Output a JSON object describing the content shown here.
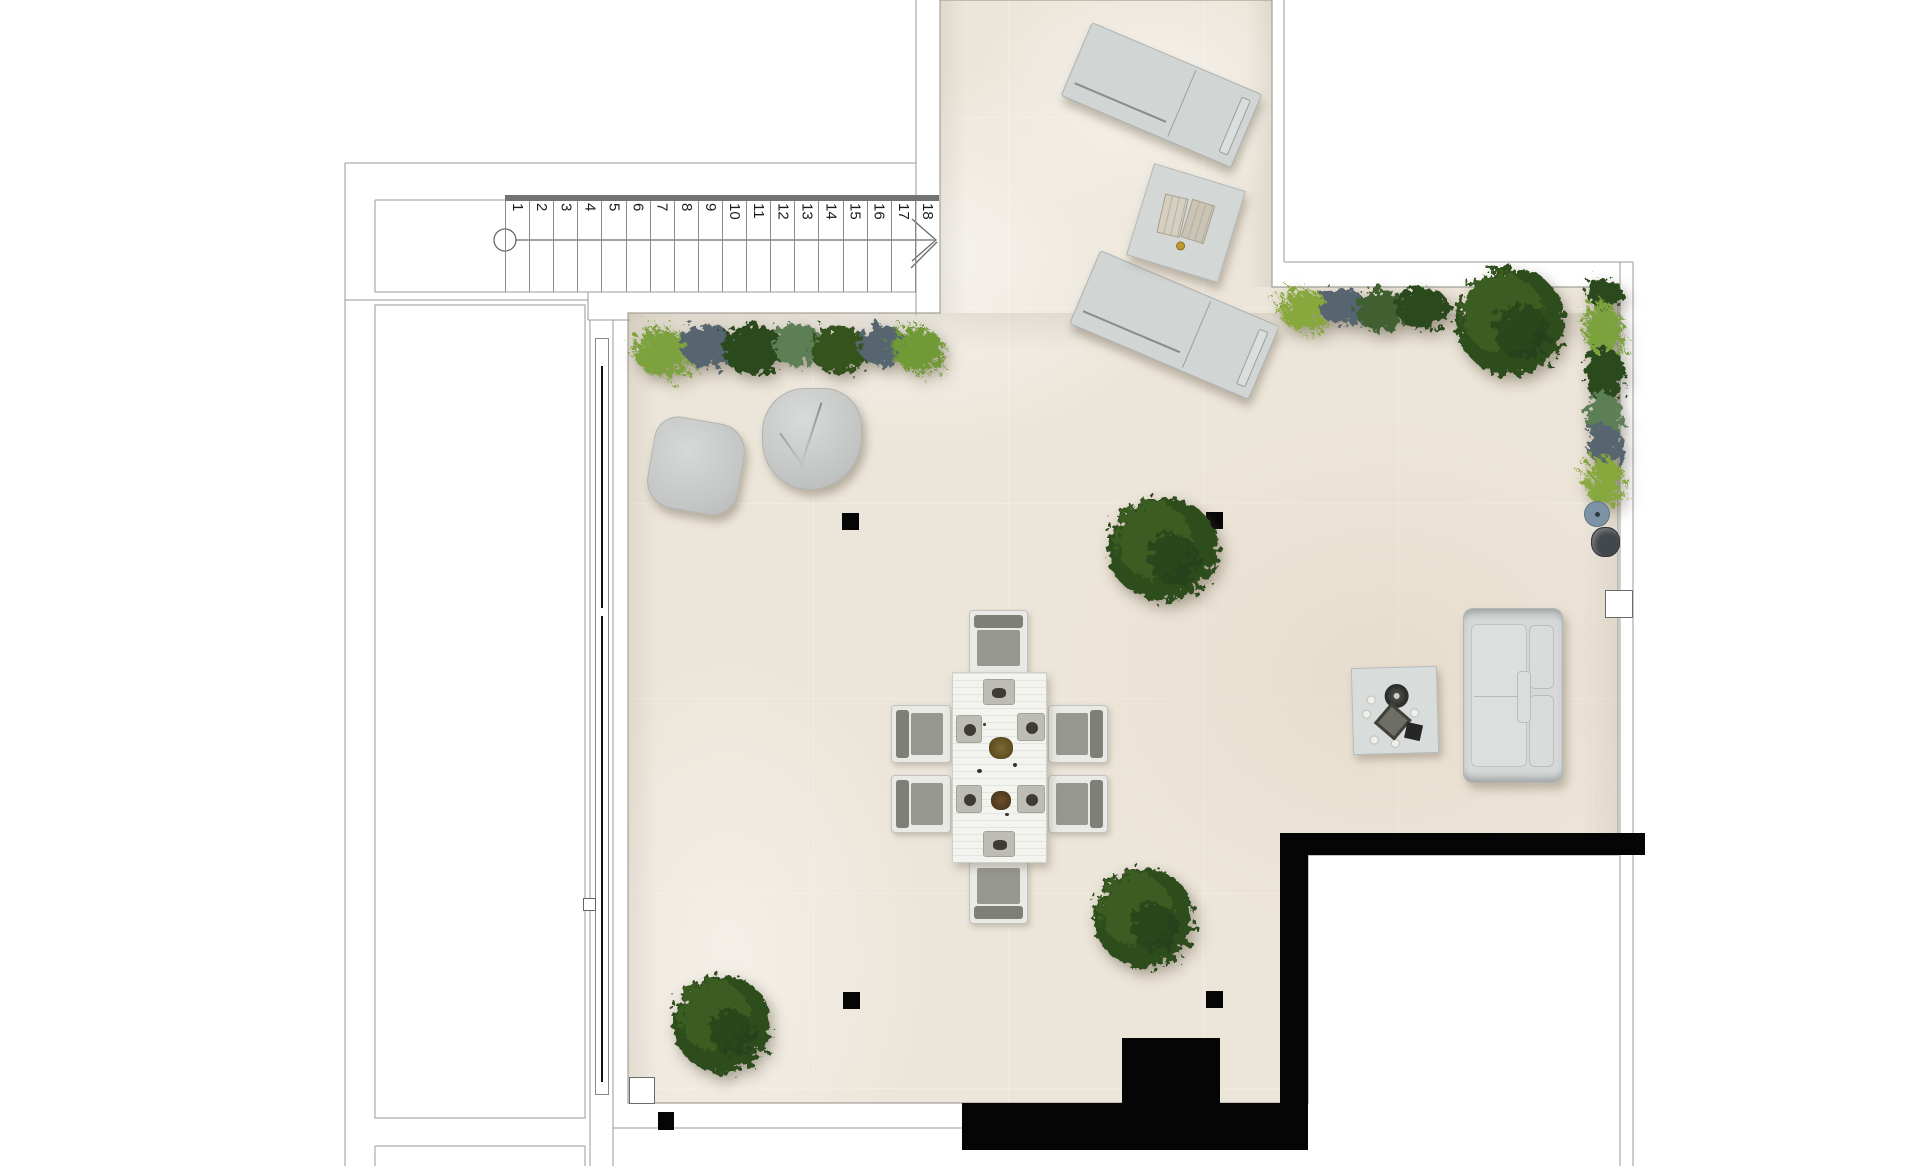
{
  "stairs": {
    "steps": [
      "1",
      "2",
      "3",
      "4",
      "5",
      "6",
      "7",
      "8",
      "9",
      "10",
      "11",
      "12",
      "13",
      "14",
      "15",
      "16",
      "17",
      "18"
    ]
  },
  "palette": {
    "floor_tile": "#ece5d9",
    "wall_line": "#9a9a9a",
    "black_wall": "#050505",
    "stair_rail": "#737373",
    "foliage_dark": "#2c481f",
    "foliage_mid": "#3c5c26",
    "foliage_light": "#7ca23c",
    "plant_bluegray": "#57656f",
    "plant_sage": "#5d7f57",
    "furniture_gray": "#d2d6d5",
    "towel_beige": "#d6cfc0",
    "pot_blue": "#7b93a4"
  }
}
